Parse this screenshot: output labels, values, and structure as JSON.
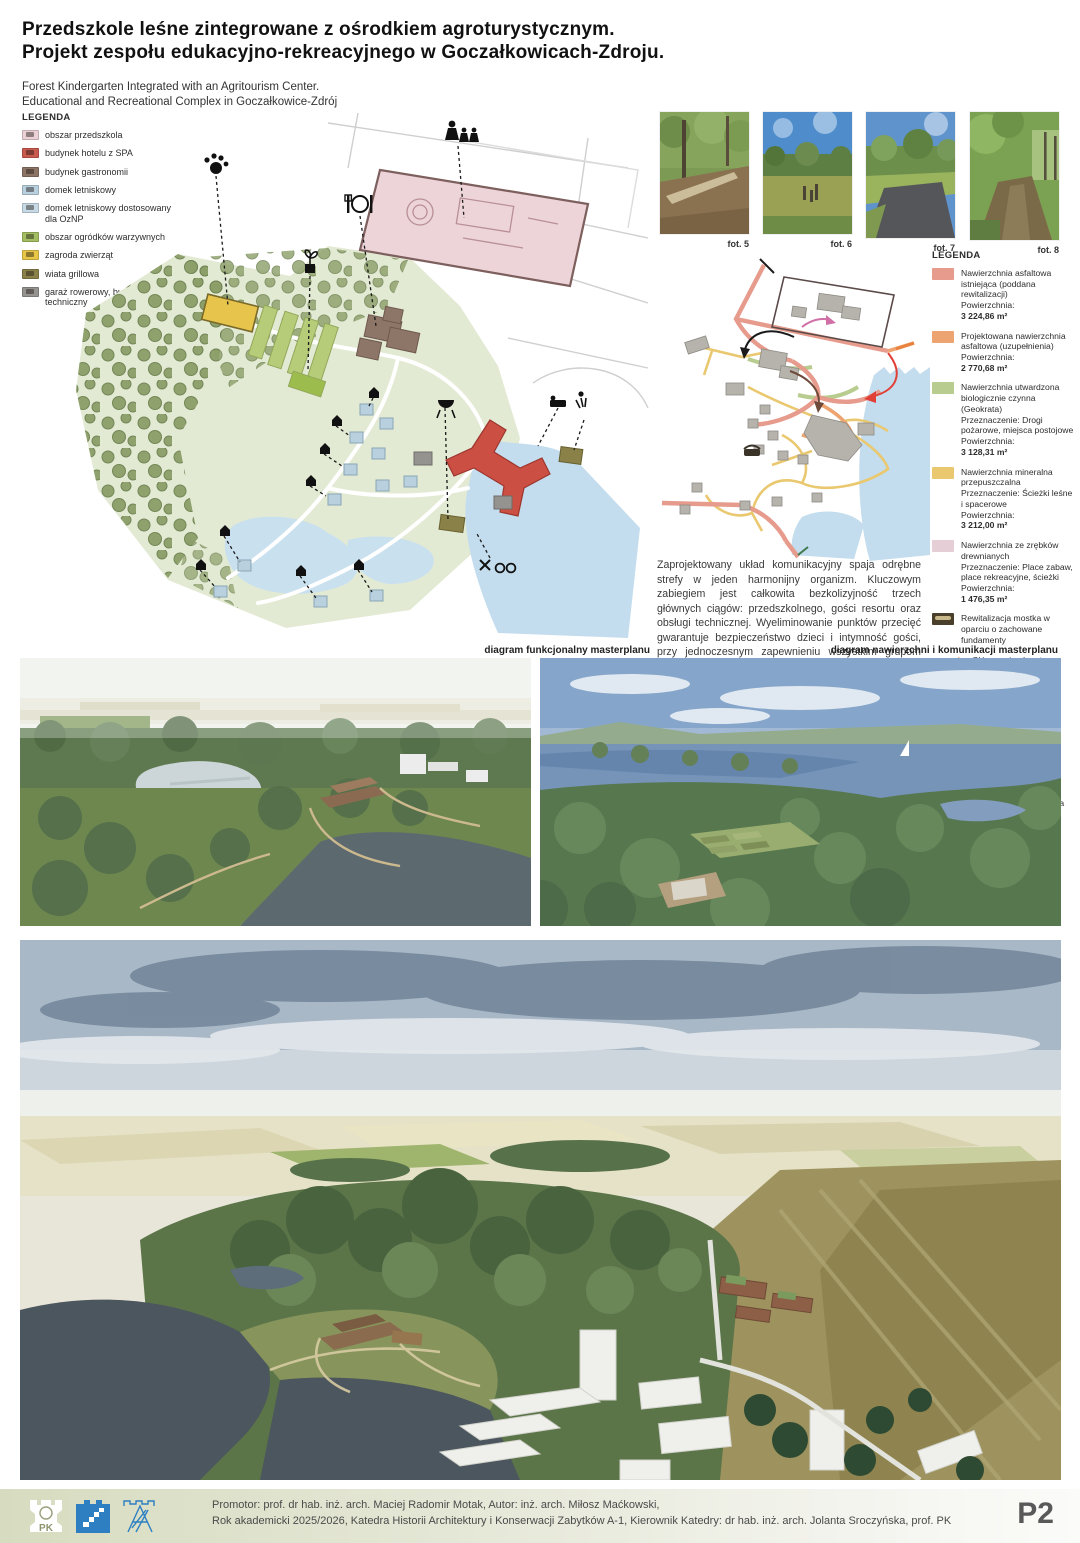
{
  "poster": {
    "title_line1": "Przedszkole leśne zintegrowane z ośrodkiem agroturystycznym.",
    "title_line2": "Projekt zespołu edukacyjno-rekreacyjnego w Goczałkowicach-Zdroju.",
    "subtitle_line1": "Forest Kindergarten Integrated with an Agritourism Center.",
    "subtitle_line2": "Educational and Recreational Complex in Goczałkowice-Zdrój"
  },
  "functional_legend": {
    "title": "LEGENDA",
    "items": [
      {
        "label": "obszar przedszkola",
        "color": "#ecd2d6"
      },
      {
        "label": "budynek hotelu z SPA",
        "color": "#c95a4e"
      },
      {
        "label": "budynek gastronomii",
        "color": "#8d7566"
      },
      {
        "label": "domek letniskowy",
        "color": "#b9d0de"
      },
      {
        "label": "domek letniskowy dostosowany dla OzNP",
        "color": "#c7dae6"
      },
      {
        "label": "obszar ogródków warzywnych",
        "color": "#a3bd62"
      },
      {
        "label": "zagroda zwierząt",
        "color": "#e8c748"
      },
      {
        "label": "wiata grillowa",
        "color": "#8a8148"
      },
      {
        "label": "garaż rowerowy, budynek techniczny",
        "color": "#95938f"
      }
    ]
  },
  "photos": [
    {
      "caption": "fot. 5"
    },
    {
      "caption": "fot. 6"
    },
    {
      "caption": "fot. 7"
    },
    {
      "caption": "fot. 8"
    }
  ],
  "surfaces_legend": {
    "title": "LEGENDA",
    "area_prefix": "Powierzchnia:",
    "items": [
      {
        "label": "Nawierzchnia asfaltowa istniejąca (poddana rewitalizacji)",
        "area_value": "3 224,86 m²",
        "color": "#e69b8d"
      },
      {
        "label": "Projektowana nawierzchnia asfaltowa (uzupełnienia)",
        "area_value": "2 770,68 m²",
        "color": "#eda470"
      },
      {
        "label": "Nawierzchnia utwardzona biologicznie czynna (Geokrata)",
        "purpose": "Przeznaczenie: Drogi pożarowe, miejsca postojowe",
        "area_value": "3 128,31 m²",
        "color": "#b7cc8e"
      },
      {
        "label": "Nawierzchnia mineralna przepuszczalna",
        "purpose": "Przeznaczenie: Ścieżki leśne i spacerowe",
        "area_value": "3 212,00 m²",
        "color": "#eac86f"
      },
      {
        "label": "Nawierzchnia ze zrębków drewnianych",
        "purpose": "Przeznaczenie: Place zabaw, place rekreacyjne, ścieżki",
        "area_value": "1 476,35 m²",
        "color": "#e5ced6"
      }
    ],
    "bridge_item": {
      "label": "Rewitalizacja mostka w oparciu o zachowane fundamenty"
    },
    "arrows": [
      {
        "label": "Główny wjazd na teren kompleksu",
        "color": "#e8813e"
      },
      {
        "label": "Dojazd kadry i obsługi przedszkola",
        "color": "#f4ddd5"
      },
      {
        "label": "„Leśna ścieżka” ciąg komunikacyjny przedszkola do jadalni",
        "color": "#d06ea6"
      },
      {
        "label": "Dojazd do strefy wypoczynkowej",
        "color": "#e04038"
      },
      {
        "label": "Ciąg komunikacyjny pensjonat - gastronomia",
        "color": "#8c6352"
      },
      {
        "label": "Obsługa techniczna i dostawy",
        "color": "#1a1a1a"
      },
      {
        "label": "szlaki rowerowe i turystyczne",
        "color": "#3f7a4f"
      }
    ]
  },
  "description": "Zaprojektowany układ komunikacyjny spaja odrębne strefy w jeden harmonijny organizm. Kluczowym zabiegiem jest całkowita bezkolizyjność trzech głównych ciągów: przedszkolnego, gości resortu oraz obsługi technicznej. Wyeliminowanie punktów przecięć gwarantuje bezpieczeństwo dzieci i intymność gości, przy jednoczesnym zapewnieniu wszystkim grupom wygodnego dostępu do wspólnych usług i gastronomii, które integrują całe założenie.",
  "captions": {
    "functional": "diagram funkcjonalny masterplanu",
    "surfaces": "diagram nawierzchni i komunikacji masterplanu"
  },
  "footer": {
    "line1": "Promotor: prof. dr hab. inż. arch. Maciej Radomir Motak, Autor: inż. arch. Miłosz Maćkowski,",
    "line2": "Rok akademicki 2025/2026, Katedra Historii Architektury i Konserwacji Zabytków A-1, Kierownik Katedry: dr hab. inż. arch. Jolanta Sroczyńska, prof. PK",
    "page_label": "P2"
  }
}
